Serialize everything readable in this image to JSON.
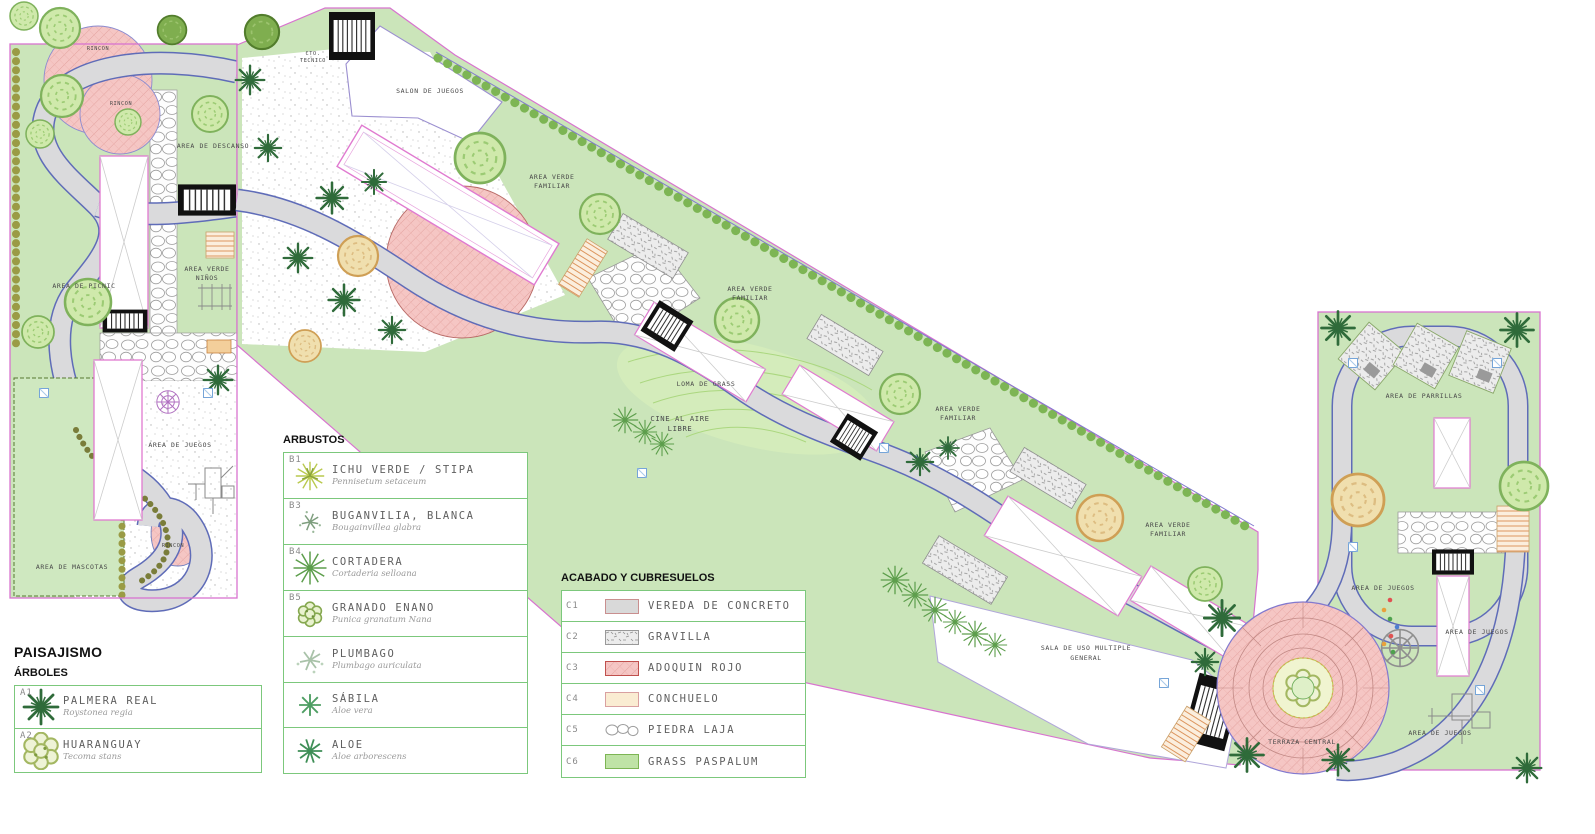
{
  "title": "PAISAJISMO",
  "plan": {
    "labels": {
      "rincon": "RINCON",
      "area_descanso": "AREA DE DESCANSO",
      "area_picnic": "AREA DE PICNIC",
      "area_verde_ninos": [
        "AREA VERDE",
        "NIÑOS"
      ],
      "area_juegos": "AREA DE JUEGOS",
      "area_mascotas": "AREA DE MASCOTAS",
      "cto_tecnico": [
        "CTO.",
        "TECNICO"
      ],
      "salon_juegos": "SALON DE JUEGOS",
      "area_verde_familiar": [
        "AREA VERDE",
        "FAMILIAR"
      ],
      "loma_grass": "LOMA DE GRASS",
      "cine": [
        "CINE AL AIRE",
        "LIBRE"
      ],
      "sala_uso_multiple": [
        "SALA DE USO MULTIPLE",
        "GENERAL"
      ],
      "area_parrillas": "AREA DE PARRILLAS",
      "terraza_central": "TERRAZA CENTRAL"
    }
  },
  "legends": {
    "arboles": {
      "heading": "ÁRBOLES",
      "items": [
        {
          "code": "A1",
          "name": "PALMERA REAL",
          "latin": "Roystonea regia",
          "icon": "palm-real-icon"
        },
        {
          "code": "A2",
          "name": "HUARANGUAY",
          "latin": "Tecoma stans",
          "icon": "huaranguay-icon"
        }
      ]
    },
    "arbustos": {
      "heading": "ARBUSTOS",
      "items": [
        {
          "code": "B1",
          "name": "ICHU VERDE / STIPA",
          "latin": "Pennisetum setaceum",
          "icon": "ichu-icon"
        },
        {
          "code": "B3",
          "name": "BUGANVILIA, BLANCA",
          "latin": "Bougainvillea glabra",
          "icon": "buganvilia-icon"
        },
        {
          "code": "B4",
          "name": "CORTADERA",
          "latin": "Cortaderia selloana",
          "icon": "cortadera-icon"
        },
        {
          "code": "B5",
          "name": "GRANADO ENANO",
          "latin": "Punica granatum Nana",
          "icon": "granado-icon"
        },
        {
          "code": "",
          "name": "PLUMBAGO",
          "latin": "Plumbago auriculata",
          "icon": "plumbago-icon"
        },
        {
          "code": "",
          "name": "SÁBILA",
          "latin": "Aloe vera",
          "icon": "sabila-icon"
        },
        {
          "code": "",
          "name": "ALOE",
          "latin": "Aloe arborescens",
          "icon": "aloe-icon"
        }
      ]
    },
    "acabados": {
      "heading": "ACABADO Y CUBRESUELOS",
      "items": [
        {
          "code": "C1",
          "name": "VEREDA DE CONCRETO",
          "swatch": "concrete",
          "color": "#d9d9d9"
        },
        {
          "code": "C2",
          "name": "GRAVILLA",
          "swatch": "gravel",
          "color": "#ececec"
        },
        {
          "code": "C3",
          "name": "ADOQUIN ROJO",
          "swatch": "paver",
          "color": "#f5c6c4"
        },
        {
          "code": "C4",
          "name": "CONCHUELO",
          "swatch": "shell",
          "color": "#faecd2"
        },
        {
          "code": "C5",
          "name": "PIEDRA LAJA",
          "swatch": "flagstone",
          "color": "#ffffff"
        },
        {
          "code": "C6",
          "name": "GRASS PASPALUM",
          "swatch": "grass",
          "color": "#bfe3a6"
        }
      ]
    }
  },
  "colors": {
    "grass": "#cbe5ba",
    "path": "#dadadc",
    "path_edge": "#5f6cb8",
    "adoquin": "#f5c6c4",
    "boundary": "#d873cf",
    "boundary2": "#8279cf",
    "hedge": "#7db554"
  }
}
